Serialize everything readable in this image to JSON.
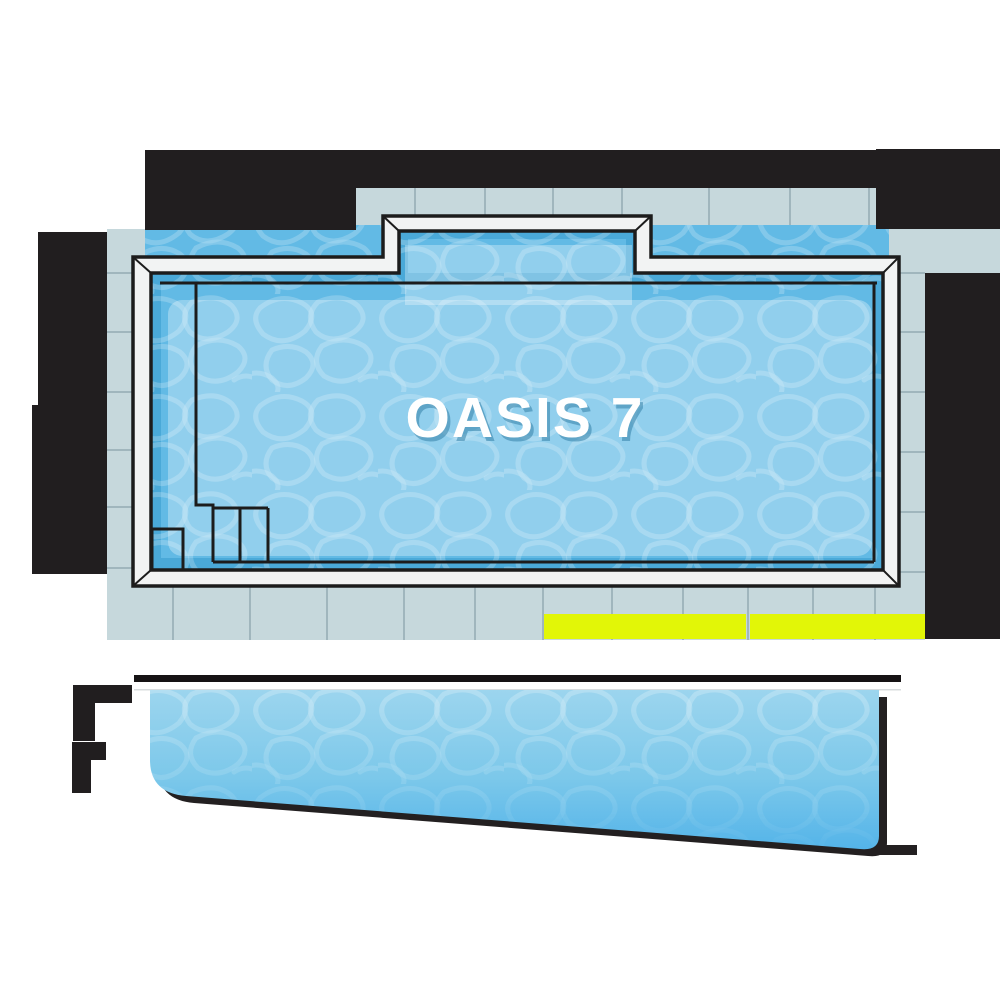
{
  "title": "Fiberglass pool model diagram",
  "pool": {
    "name": "OASIS 7"
  },
  "views": {
    "top_view": "pool top (plan) view with paver deck",
    "side_view": "pool depth profile (side) view"
  },
  "marks": {
    "top": "dimension-bar (redacted black bar above deck)",
    "left": "dimension-bar (redacted black bar left of deck)",
    "right": "dimension-bar (redacted black bar right of deck)",
    "depth_shallow": "dimension-mark (black mark, side view left top)",
    "depth_deep": "dimension-mark (black mark, side view left bottom)",
    "length_highlight": "yellow highlight strip over bottom deck row"
  },
  "colors": {
    "bar": "#211e1f",
    "deck": "#c6d8dc",
    "grout": "#a0b6bd",
    "coping": "#f2f3f3",
    "outline": "#1c1c1c",
    "accent": "#e2f607",
    "water-base": "#62bae5",
    "water-dark": "#4aa9d8",
    "water-light": "#94d4ee",
    "side-top": "#9cd5ee",
    "side-bottom": "#54b4e9",
    "shadow": "#232021",
    "label": "#ffffff",
    "label-shadow": "#3482a8"
  }
}
